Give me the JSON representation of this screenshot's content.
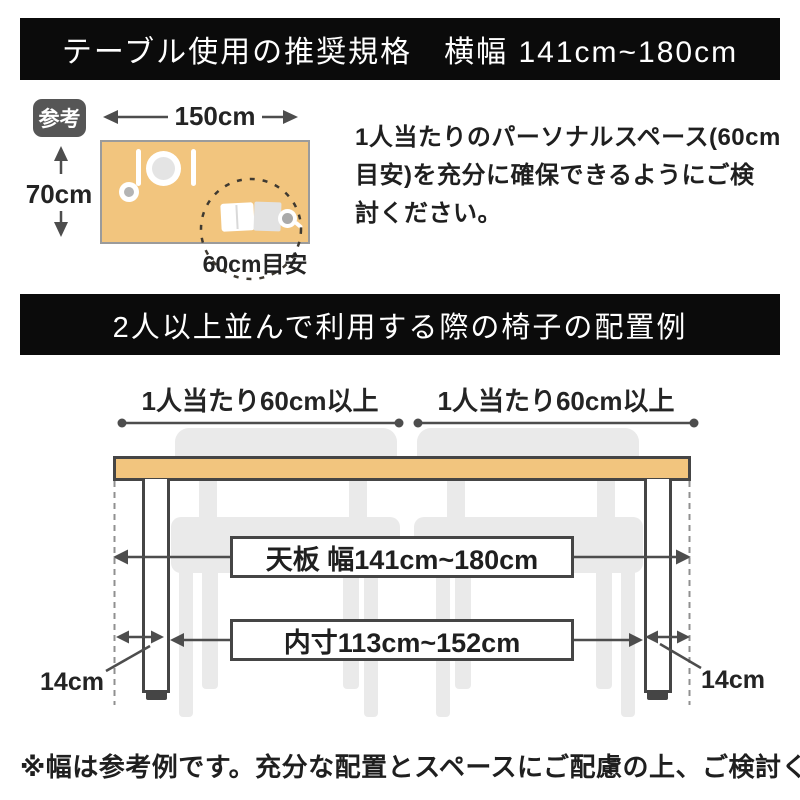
{
  "banners": {
    "spec_title": "テーブル使用の推奨規格　横幅 141cm~180cm",
    "layout_title": "2人以上並んで利用する際の椅子の配置例"
  },
  "reference": {
    "badge": "参考",
    "table_width": "150cm",
    "table_depth": "70cm",
    "space_hint": "60cm目安",
    "note_lines": [
      "1人当たりのパーソナルスペース(60cm",
      "目安)を充分に確保できるようにご検",
      "討ください。"
    ]
  },
  "layout": {
    "per_person_left": "1人当たり60cm以上",
    "per_person_right": "1人当たり60cm以上",
    "tabletop_width": "天板 幅141cm~180cm",
    "inner_width": "内寸113cm~152cm",
    "leg_inset_left": "14cm",
    "leg_inset_right": "14cm"
  },
  "footer": {
    "note": "※幅は参考例です。充分な配置とスペースにご配慮の上、ご検討ください。"
  },
  "colors": {
    "banner_bg": "#0B0B0B",
    "banner_text": "#FFFFFF",
    "tabletop": "#F2C57E",
    "chair": "#EAEAEA",
    "line": "#4D4D4D",
    "badge_bg": "#565656",
    "text": "#1F1F1F"
  }
}
